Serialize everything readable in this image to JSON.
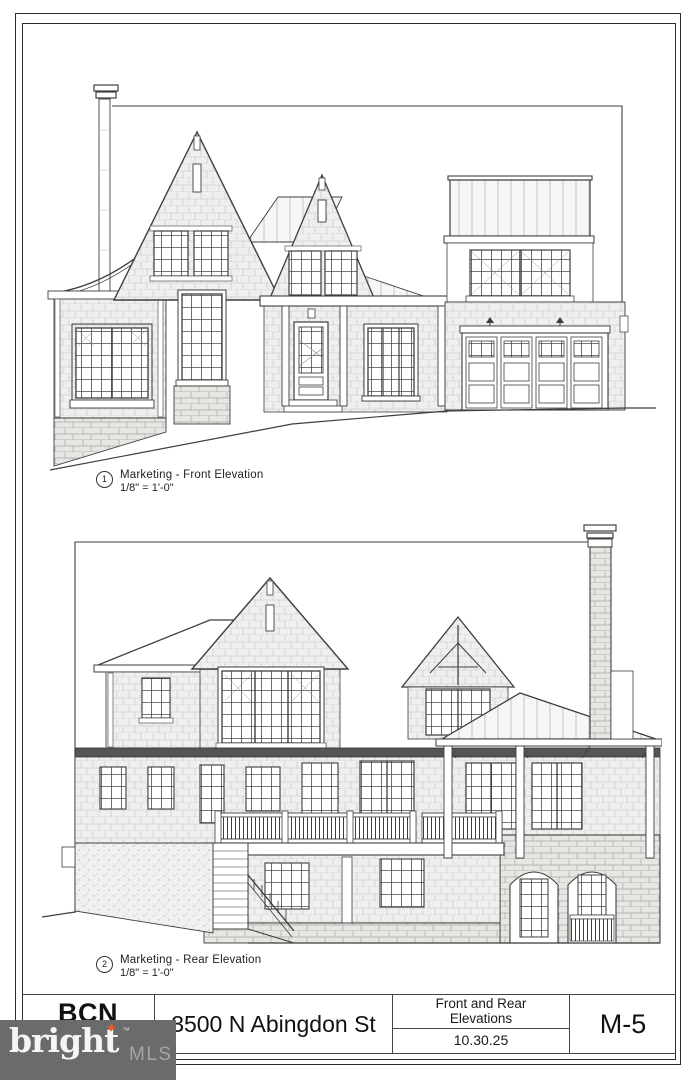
{
  "sheet": {
    "drawings": [
      {
        "number": "1",
        "title": "Marketing - Front Elevation",
        "scale": "1/8\" = 1'-0\""
      },
      {
        "number": "2",
        "title": "Marketing - Rear Elevation",
        "scale": "1/8\" = 1'-0\""
      }
    ],
    "title_block": {
      "logo_text": "BCN",
      "address": "3500 N Abingdon St",
      "sheet_title_line1": "Front and Rear",
      "sheet_title_line2": "Elevations",
      "date": "10.30.25",
      "sheet_number": "M-5"
    },
    "watermark": {
      "brand": "bright",
      "tm": "™",
      "suffix": "MLS",
      "spark_glyph": "✦"
    },
    "colors": {
      "paper": "#ffffff",
      "ink": "#3f3e3c",
      "watermark_bg": "#6a6b6d",
      "watermark_brand": "#f6f5f2",
      "watermark_suffix": "#a3a5a7",
      "watermark_spark": "#e85a2e"
    }
  }
}
